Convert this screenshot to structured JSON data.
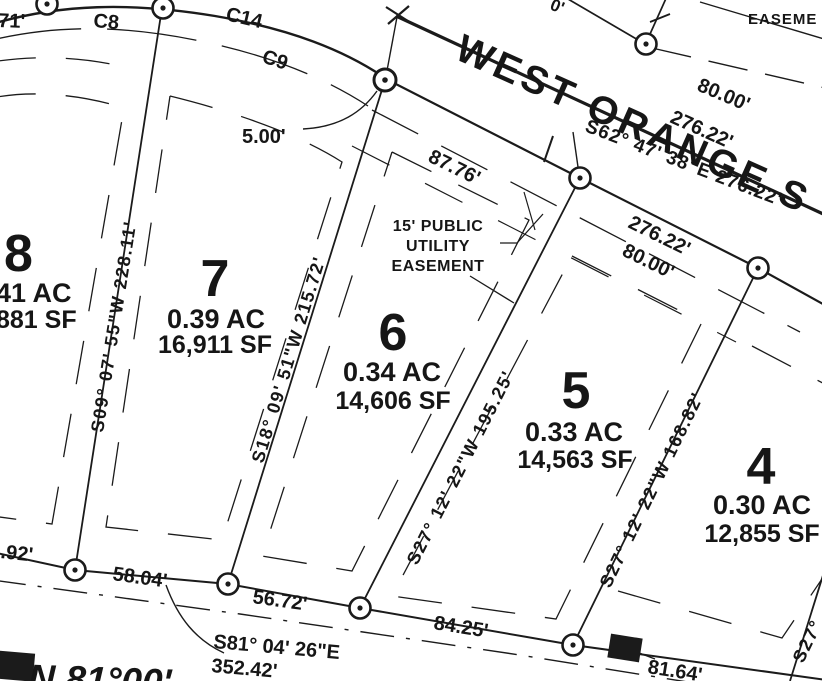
{
  "street": {
    "name": "WEST ORANGE S",
    "bearing": "S62° 47' 38\"E 276.22'"
  },
  "top_right_partial": "EASEME",
  "easement_note": {
    "line1": "15'  PUBLIC",
    "line2": "UTILITY",
    "line3": "EASEMENT"
  },
  "curve_labels": {
    "c8": "C8",
    "c14": "C14",
    "c9": "C9"
  },
  "lots": [
    {
      "number": "8",
      "acres": "41 AC",
      "sqft": "881 SF"
    },
    {
      "number": "7",
      "acres": "0.39 AC",
      "sqft": "16,911 SF"
    },
    {
      "number": "6",
      "acres": "0.34 AC",
      "sqft": "14,606 SF"
    },
    {
      "number": "5",
      "acres": "0.33 AC",
      "sqft": "14,563 SF"
    },
    {
      "number": "4",
      "acres": "0.30 AC",
      "sqft": "12,855 SF"
    }
  ],
  "lot_line_bearings": {
    "lot8_7": "S09° 07' 55\"W 228.11'",
    "lot7_6": "S18° 09' 51\"W 215.72'",
    "lot6_5": "S27° 12' 22\"W 195.25'",
    "lot5_4": "S27° 12' 22\"W 168.82'",
    "right_partial": "S27°"
  },
  "dimensions": {
    "top_left_partial": "71'",
    "offset_5": "5.00'",
    "frontage_87": "87.76'",
    "row_upper_80": "80.00'",
    "row_upper_276": "276.22'",
    "row_lower_276": "276.22'",
    "row_lower_80": "80.00'",
    "top_edge_partial": "0'",
    "rear_partial_92": ".92'",
    "rear_58": "58.04'",
    "rear_56": "56.72'",
    "rear_84": "84.25'",
    "rear_81": "81.64'"
  },
  "rear_line": {
    "bearing": "S81° 04' 26\"E",
    "distance": "352.42'",
    "bold_partial": "N 81°00'"
  },
  "colors": {
    "ink": "#1b1b1b",
    "paper": "#ffffff"
  }
}
